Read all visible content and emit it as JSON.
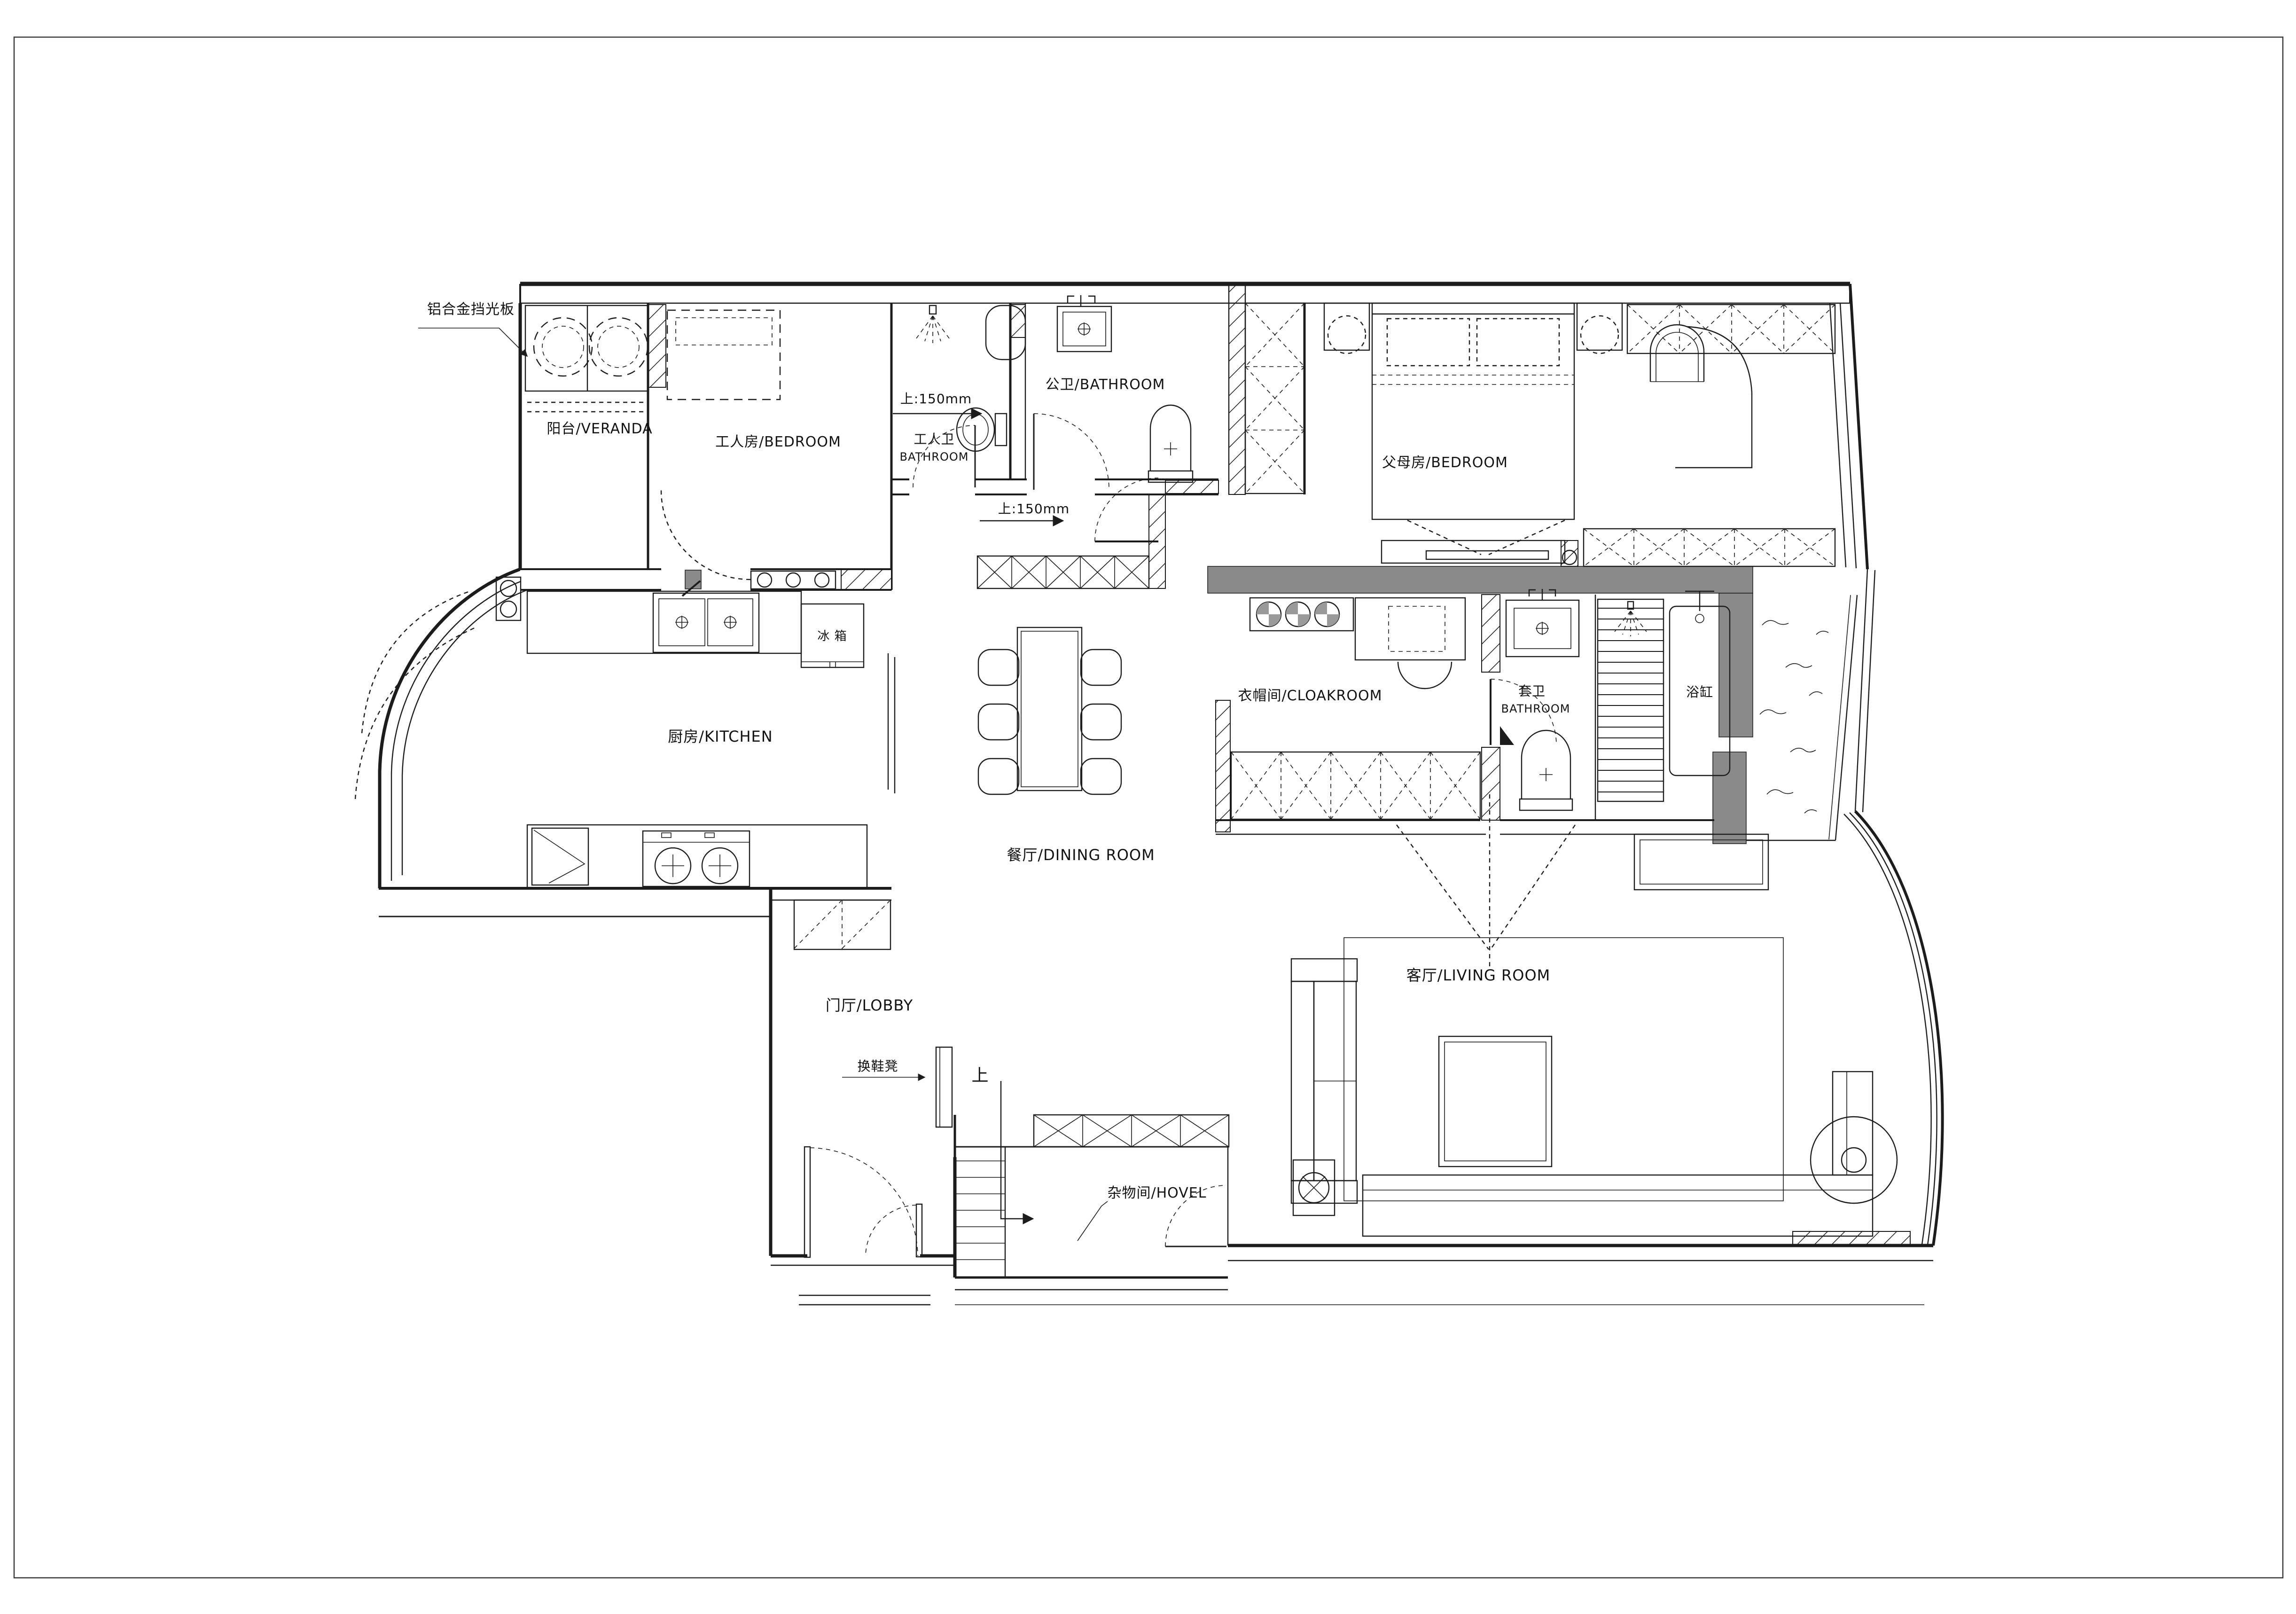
{
  "drawing": {
    "kind": "residential floor plan",
    "colors": {
      "line": "#1c1c1c",
      "poche_wall": "#8a8a8a",
      "background": "#ffffff"
    },
    "labels": {
      "shade_panel": "铝合金挡光板",
      "veranda": "阳台/VERANDA",
      "worker_bedroom": "工人房/BEDROOM",
      "worker_bath_cn": "工人卫",
      "worker_bath_en": "BATHROOM",
      "step_bath": "上:150mm",
      "public_bath": "公卫/BATHROOM",
      "parents_bedroom": "父母房/BEDROOM",
      "step_hall": "上:150mm",
      "fridge": "冰 箱",
      "kitchen": "厨房/KITCHEN",
      "cloakroom": "衣帽间/CLOAKROOM",
      "ensuite_cn": "套卫",
      "ensuite_en": "BATHROOM",
      "bathtub": "浴缸",
      "dining": "餐厅/DINING ROOM",
      "lobby": "门厅/LOBBY",
      "shoe_bench": "换鞋凳",
      "up": "上",
      "hovel": "杂物间/HOVEL",
      "living": "客厅/LIVING ROOM"
    }
  }
}
